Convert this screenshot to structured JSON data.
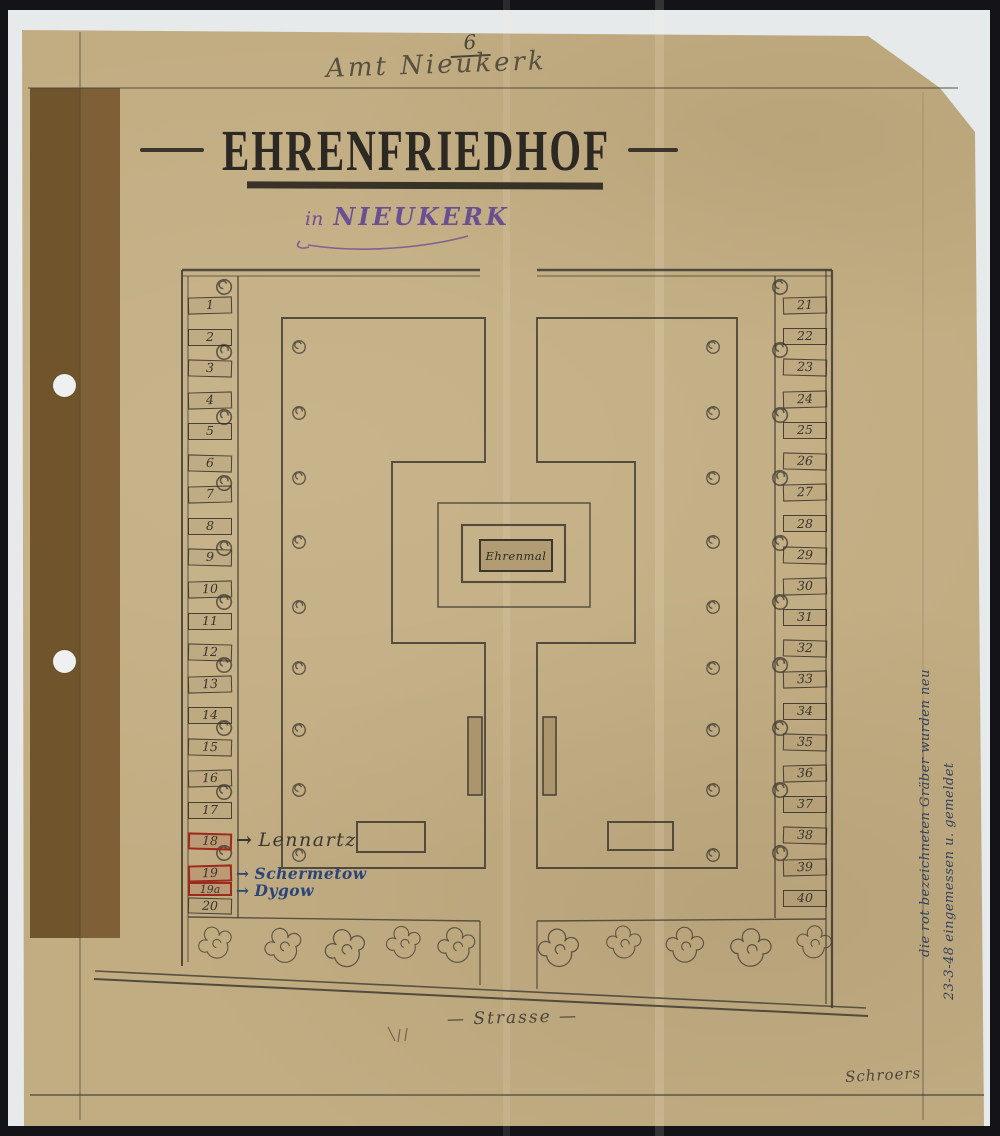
{
  "scan": {
    "background": "#131318",
    "backing": "#e7eaea",
    "paper": "#c2ad83",
    "tape": "#6d5028"
  },
  "header": {
    "page_number": "6",
    "office_line": "Amt Nieukerk"
  },
  "title": {
    "text": "EHRENFRIEDHOF"
  },
  "subtitle": {
    "prefix": "in",
    "place": "NIEUKERK",
    "color": "#6b4f93"
  },
  "memorial": {
    "label": "Ehrenmal"
  },
  "street": {
    "label": "— Strasse —"
  },
  "signature": {
    "text": "Schroers"
  },
  "margin_note": {
    "line1": "die rot bezeichneten Gräber wurden neu",
    "line2": "23-3-48 eingemessen u. gemeldet",
    "color": "#35425c"
  },
  "plan": {
    "red_color": "#9b2a1f",
    "ink_blue": "#2a4579",
    "pencil": "#3c372e",
    "left_graves": [
      {
        "label": "1"
      },
      {
        "label": "2"
      },
      {
        "label": "3"
      },
      {
        "label": "4"
      },
      {
        "label": "5"
      },
      {
        "label": "6"
      },
      {
        "label": "7"
      },
      {
        "label": "8"
      },
      {
        "label": "9"
      },
      {
        "label": "10"
      },
      {
        "label": "11"
      },
      {
        "label": "12"
      },
      {
        "label": "13"
      },
      {
        "label": "14"
      },
      {
        "label": "15"
      },
      {
        "label": "16"
      },
      {
        "label": "17"
      },
      {
        "label": "18",
        "red": true,
        "name": "Lennartz",
        "ink": "pencil"
      },
      {
        "label": "19",
        "red": true,
        "name": "Schermetow",
        "ink": "blue"
      },
      {
        "label": "19a",
        "red": true,
        "name": "Dygow",
        "ink": "blue"
      },
      {
        "label": "20"
      }
    ],
    "right_graves": [
      {
        "label": "21"
      },
      {
        "label": "22"
      },
      {
        "label": "23"
      },
      {
        "label": "24"
      },
      {
        "label": "25"
      },
      {
        "label": "26"
      },
      {
        "label": "27"
      },
      {
        "label": "28"
      },
      {
        "label": "29"
      },
      {
        "label": "30"
      },
      {
        "label": "31"
      },
      {
        "label": "32"
      },
      {
        "label": "33"
      },
      {
        "label": "34"
      },
      {
        "label": "35"
      },
      {
        "label": "36"
      },
      {
        "label": "37"
      },
      {
        "label": "38"
      },
      {
        "label": "39"
      },
      {
        "label": "40"
      }
    ]
  }
}
